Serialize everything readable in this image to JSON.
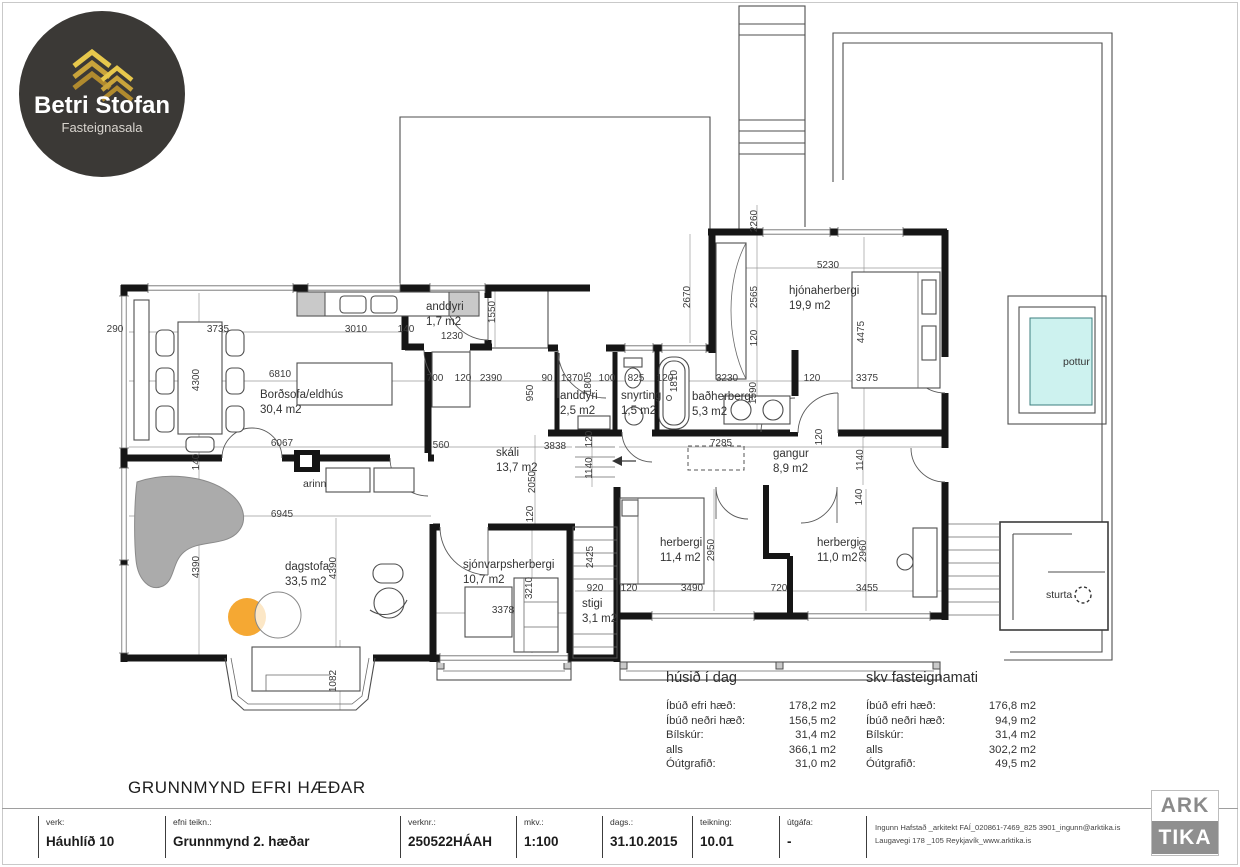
{
  "branding": {
    "logo_line1": "Betri Stofan",
    "logo_line2": "Fasteignasala"
  },
  "heading": "GRUNNMYND EFRI HÆÐAR",
  "arktika": {
    "top": "ARK",
    "bottom": "TIKA"
  },
  "colors": {
    "wall": "#161616",
    "accent_orange": "#F5A833",
    "pottur_fill": "#CDF2EF",
    "logo_bg": "#3B3936",
    "logo_gold": "#C9A43B",
    "arktika_gray": "#8F8F8F"
  },
  "titleblock": {
    "fields": [
      {
        "label": "verk:",
        "value": "Háuhlíð 10"
      },
      {
        "label": "efni teikn.:",
        "value": "Grunnmynd 2. hæðar"
      },
      {
        "label": "verknr.:",
        "value": "250522HÁAH"
      },
      {
        "label": "mkv.:",
        "value": "1:100"
      },
      {
        "label": "dags.:",
        "value": "31.10.2015"
      },
      {
        "label": "teikning:",
        "value": "10.01"
      },
      {
        "label": "útgáfa:",
        "value": "-"
      }
    ],
    "architect_line1": "Ingunn Hafstað _arkitekt FAÍ_020861-7469_825 3901_ingunn@arktika.is",
    "architect_line2": "Laugavegi 178 _105 Reykjavík_www.arktika.is"
  },
  "area_tables": [
    {
      "title": "húsið í dag",
      "rows": [
        [
          "Íbúð efri hæð:",
          "178,2 m2"
        ],
        [
          "Íbúð neðri hæð:",
          "156,5 m2"
        ],
        [
          "Bílskúr:",
          "31,4 m2"
        ],
        [
          "alls",
          "366,1 m2"
        ],
        [
          "Óútgrafið:",
          "31,0 m2"
        ]
      ]
    },
    {
      "title": "skv fasteignamati",
      "rows": [
        [
          "Íbúð efri hæð:",
          "176,8 m2"
        ],
        [
          "Íbúð neðri hæð:",
          "94,9 m2"
        ],
        [
          "Bílskúr:",
          "31,4 m2"
        ],
        [
          "alls",
          "302,2 m2"
        ],
        [
          "Óútgrafið:",
          "49,5 m2"
        ]
      ]
    }
  ],
  "plan": {
    "rooms": [
      {
        "name": "Borðsofa/eldhús",
        "area": "30,4 m2",
        "x": 260,
        "y": 398
      },
      {
        "name": "anddyri",
        "area": "1,7 m2",
        "x": 426,
        "y": 310
      },
      {
        "name": "skáli",
        "area": "13,7 m2",
        "x": 496,
        "y": 456
      },
      {
        "name": "anddyri",
        "area": "2,5 m2",
        "x": 560,
        "y": 399
      },
      {
        "name": "snyrting",
        "area": "1,5 m2",
        "x": 621,
        "y": 399
      },
      {
        "name": "baðherbergi",
        "area": "5,3 m2",
        "x": 692,
        "y": 400
      },
      {
        "name": "hjónaherbergi",
        "area": "19,9 m2",
        "x": 789,
        "y": 294
      },
      {
        "name": "gangur",
        "area": "8,9 m2",
        "x": 773,
        "y": 457
      },
      {
        "name": "herbergi",
        "area": "11,4 m2",
        "x": 660,
        "y": 546
      },
      {
        "name": "herbergi",
        "area": "11,0 m2",
        "x": 817,
        "y": 546
      },
      {
        "name": "dagstofa",
        "area": "33,5 m2",
        "x": 285,
        "y": 570
      },
      {
        "name": "sjónvarpsherbergi",
        "area": "10,7 m2",
        "x": 463,
        "y": 568
      },
      {
        "name": "stigi",
        "area": "3,1 m2",
        "x": 582,
        "y": 607
      }
    ],
    "misc_labels": [
      {
        "t": "arinn",
        "x": 303,
        "y": 487
      },
      {
        "t": "pottur",
        "x": 1063,
        "y": 365
      },
      {
        "t": "sturta",
        "x": 1046,
        "y": 598
      }
    ],
    "dimensions": [
      {
        "t": "290",
        "x": 115,
        "y": 332
      },
      {
        "t": "3735",
        "x": 218,
        "y": 332
      },
      {
        "t": "3010",
        "x": 356,
        "y": 332
      },
      {
        "t": "140",
        "x": 406,
        "y": 332
      },
      {
        "t": "1230",
        "x": 452,
        "y": 339
      },
      {
        "t": "6810",
        "x": 280,
        "y": 377
      },
      {
        "t": "700",
        "x": 435,
        "y": 381
      },
      {
        "t": "120",
        "x": 463,
        "y": 381
      },
      {
        "t": "2390",
        "x": 491,
        "y": 381
      },
      {
        "t": "90",
        "x": 547,
        "y": 381
      },
      {
        "t": "1370",
        "x": 572,
        "y": 381
      },
      {
        "t": "100",
        "x": 607,
        "y": 381
      },
      {
        "t": "825",
        "x": 636,
        "y": 381
      },
      {
        "t": "120",
        "x": 665,
        "y": 381
      },
      {
        "t": "3230",
        "x": 727,
        "y": 381
      },
      {
        "t": "120",
        "x": 812,
        "y": 381
      },
      {
        "t": "3375",
        "x": 867,
        "y": 381
      },
      {
        "t": "5230",
        "x": 828,
        "y": 268
      },
      {
        "t": "6067",
        "x": 282,
        "y": 446
      },
      {
        "t": "560",
        "x": 441,
        "y": 448
      },
      {
        "t": "3838",
        "x": 555,
        "y": 449
      },
      {
        "t": "7285",
        "x": 721,
        "y": 446
      },
      {
        "t": "6945",
        "x": 282,
        "y": 517
      },
      {
        "t": "3378",
        "x": 503,
        "y": 613
      },
      {
        "t": "920",
        "x": 595,
        "y": 591
      },
      {
        "t": "120",
        "x": 629,
        "y": 591
      },
      {
        "t": "3490",
        "x": 692,
        "y": 591
      },
      {
        "t": "720",
        "x": 779,
        "y": 591
      },
      {
        "t": "3455",
        "x": 867,
        "y": 591
      },
      {
        "t": "4300",
        "x": 199,
        "y": 380,
        "r": 1
      },
      {
        "t": "1550",
        "x": 495,
        "y": 312,
        "r": 1
      },
      {
        "t": "950",
        "x": 533,
        "y": 393,
        "r": 1
      },
      {
        "t": "1805",
        "x": 591,
        "y": 383,
        "r": 1
      },
      {
        "t": "1810",
        "x": 677,
        "y": 381,
        "r": 1
      },
      {
        "t": "2670",
        "x": 690,
        "y": 297,
        "r": 1
      },
      {
        "t": "2260",
        "x": 757,
        "y": 221,
        "r": 1
      },
      {
        "t": "2565",
        "x": 757,
        "y": 297,
        "r": 1
      },
      {
        "t": "120",
        "x": 757,
        "y": 338,
        "r": 1
      },
      {
        "t": "4475",
        "x": 864,
        "y": 332,
        "r": 1
      },
      {
        "t": "1590",
        "x": 756,
        "y": 393,
        "r": 1
      },
      {
        "t": "2050",
        "x": 535,
        "y": 482,
        "r": 1
      },
      {
        "t": "120",
        "x": 533,
        "y": 514,
        "r": 1
      },
      {
        "t": "120",
        "x": 592,
        "y": 439,
        "r": 1
      },
      {
        "t": "1140",
        "x": 592,
        "y": 468,
        "r": 1
      },
      {
        "t": "1140",
        "x": 863,
        "y": 460,
        "r": 1
      },
      {
        "t": "120",
        "x": 822,
        "y": 437,
        "r": 1
      },
      {
        "t": "140",
        "x": 199,
        "y": 462,
        "r": 1
      },
      {
        "t": "4390",
        "x": 199,
        "y": 567,
        "r": 1
      },
      {
        "t": "4390",
        "x": 336,
        "y": 568,
        "r": 1
      },
      {
        "t": "2950",
        "x": 714,
        "y": 550,
        "r": 1
      },
      {
        "t": "2960",
        "x": 866,
        "y": 551,
        "r": 1
      },
      {
        "t": "140",
        "x": 862,
        "y": 497,
        "r": 1
      },
      {
        "t": "3210",
        "x": 532,
        "y": 588,
        "r": 1
      },
      {
        "t": "2425",
        "x": 593,
        "y": 557,
        "r": 1
      },
      {
        "t": "1082",
        "x": 336,
        "y": 681,
        "r": 1
      }
    ]
  }
}
